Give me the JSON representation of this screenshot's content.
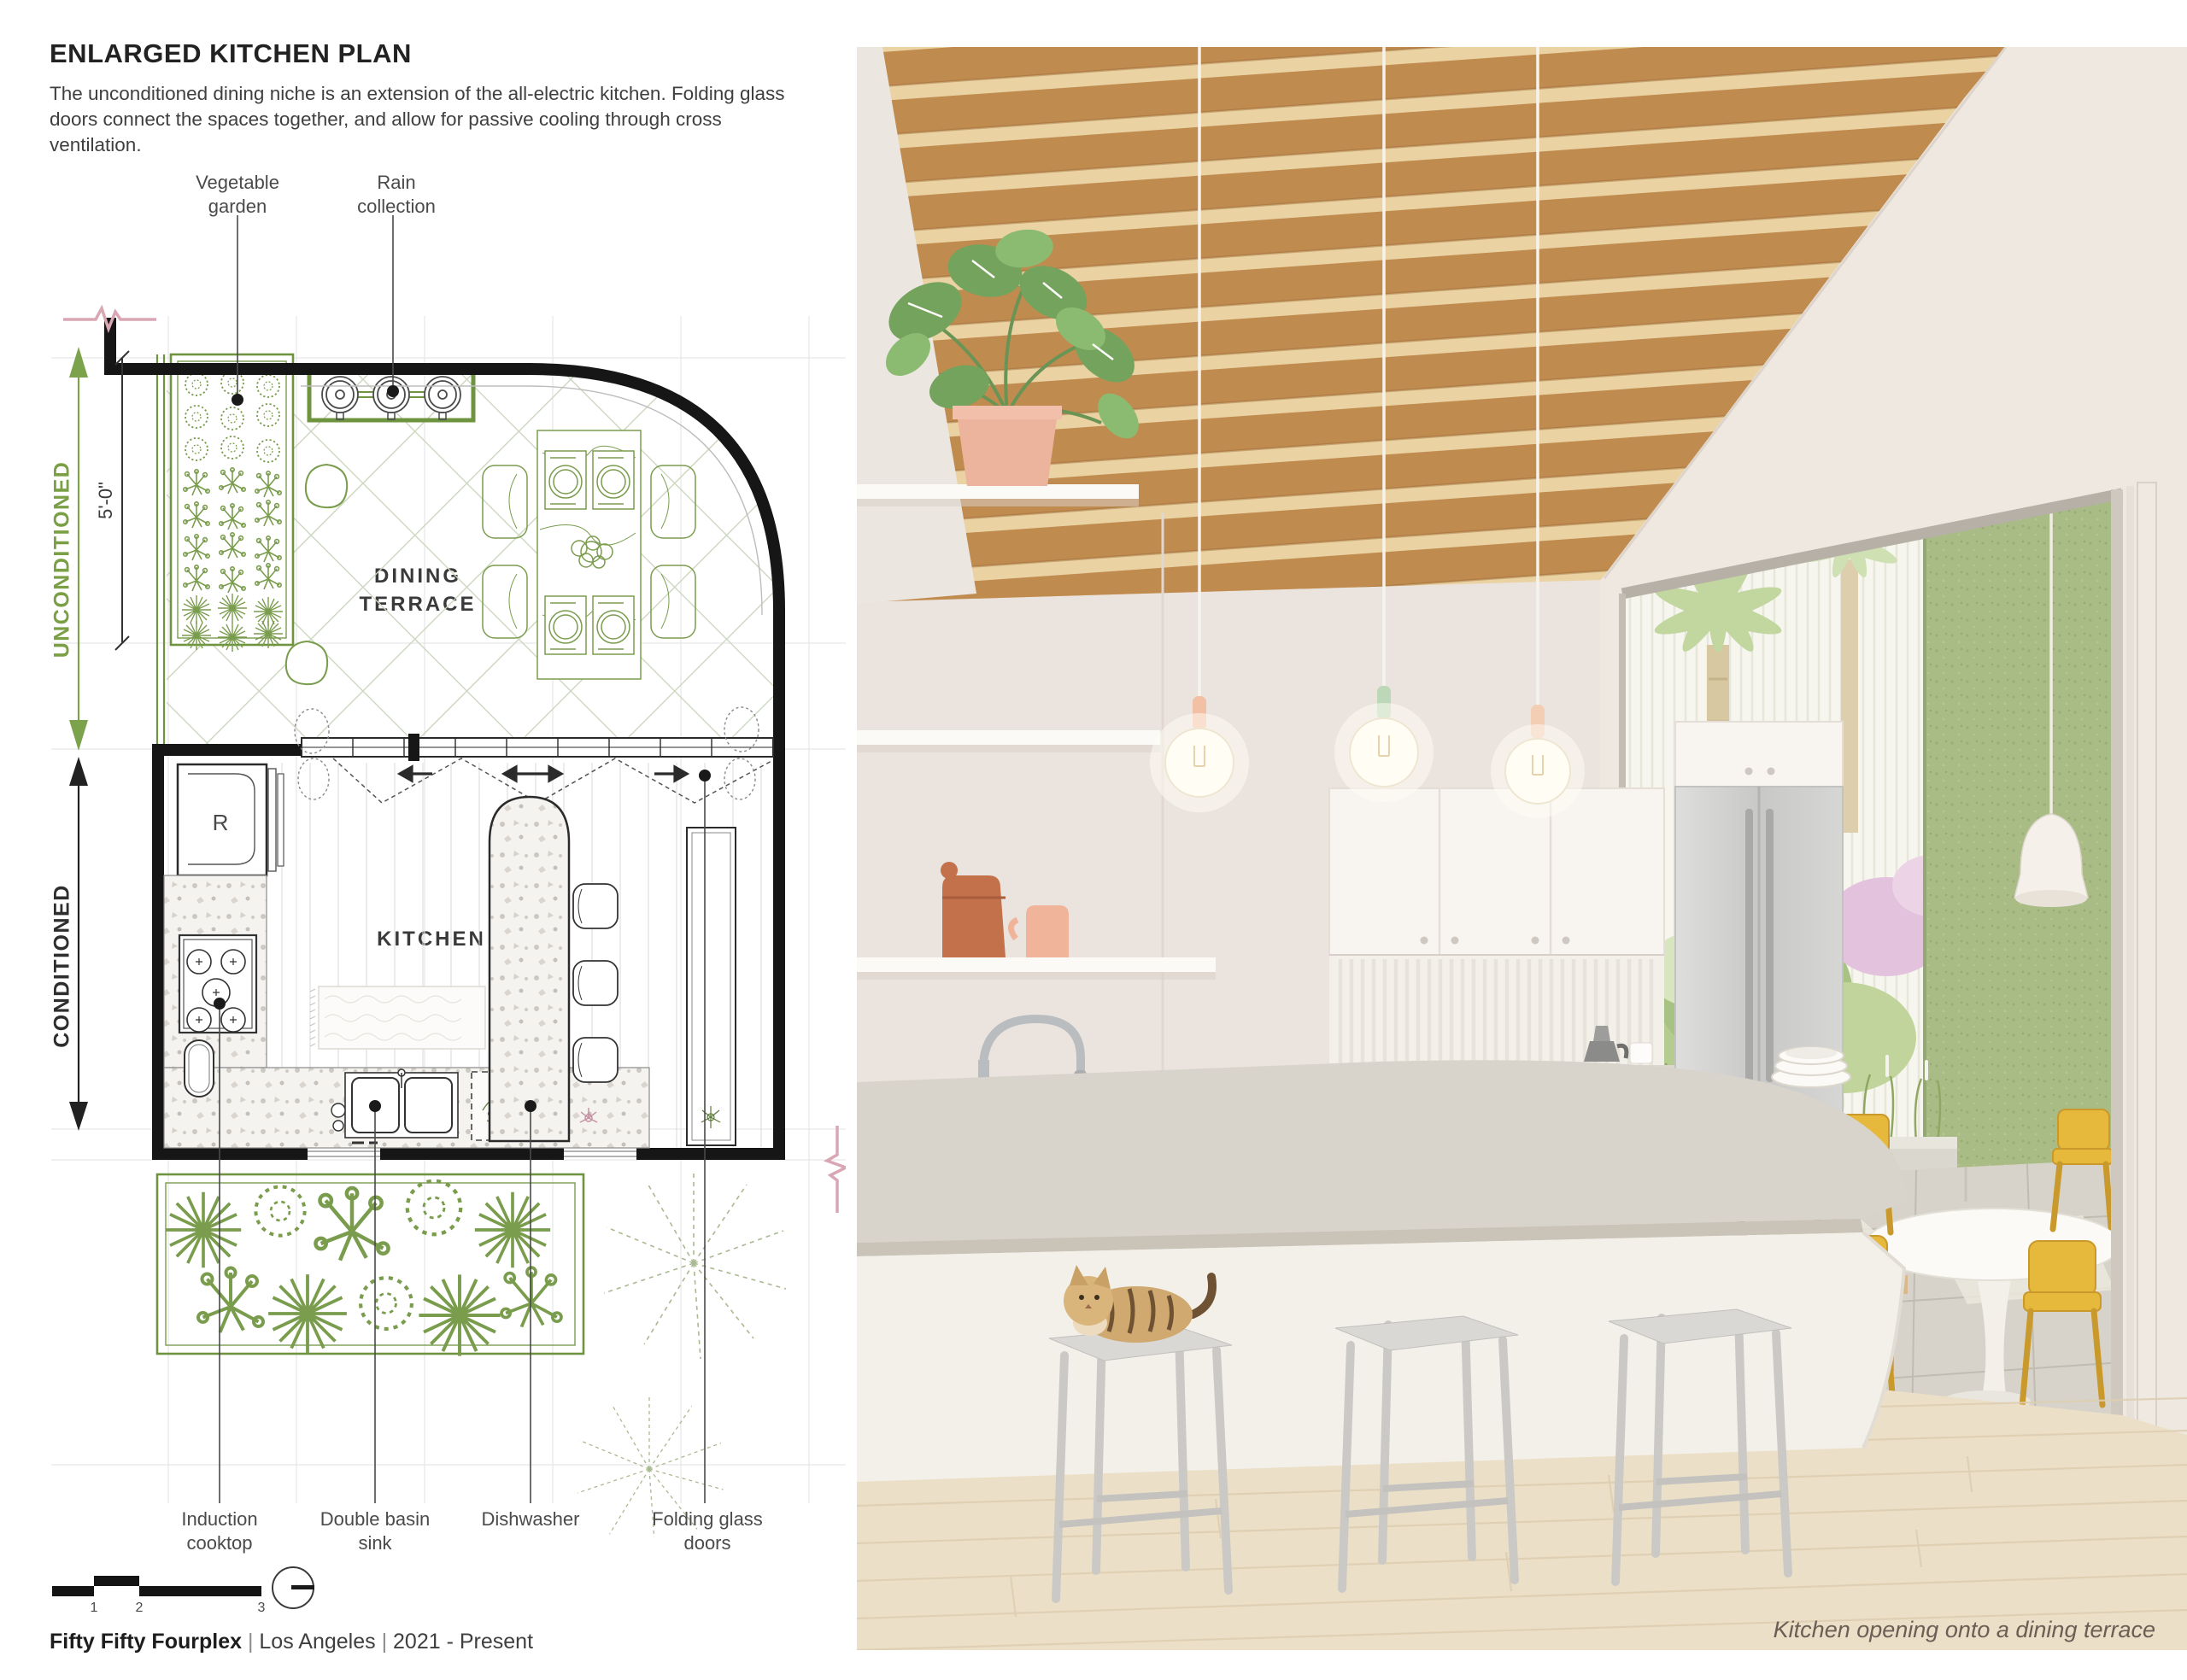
{
  "header": {
    "title": "ENLARGED KITCHEN PLAN",
    "description": "The unconditioned dining niche is an extension of the all-electric kitchen. Folding glass doors connect the spaces together, and allow for passive cooling through cross ventilation."
  },
  "plan": {
    "zone_labels": {
      "unconditioned": "UNCONDITIONED",
      "conditioned": "CONDITIONED"
    },
    "dimension": "5'-0\"",
    "room_labels": {
      "dining_terrace": "DINING TERRACE",
      "kitchen": "KITCHEN",
      "refrigerator": "R"
    },
    "callouts_top": [
      {
        "label": "Vegetable garden"
      },
      {
        "label": "Rain collection"
      }
    ],
    "callouts_bottom": [
      {
        "label": "Induction cooktop"
      },
      {
        "label": "Double basin sink"
      },
      {
        "label": "Dishwasher"
      },
      {
        "label": "Folding glass doors"
      }
    ],
    "colors": {
      "plan_green": "#6f9440",
      "zone_green": "#7a9f45",
      "section_cut_pink": "#d9a6b4",
      "wall_black": "#161616"
    }
  },
  "scale_bar": {
    "ticks": [
      "1",
      "2",
      "3"
    ],
    "icon": "north-indicator"
  },
  "footer": {
    "project": "Fifty Fifty Fourplex",
    "separator": "|",
    "location": "Los Angeles",
    "dates": "2021 - Present"
  },
  "render": {
    "caption": "Kitchen opening onto a dining terrace",
    "colors": {
      "wood_beam": "#c08b4f",
      "chair_yellow": "#e6b83c",
      "stucco_green": "#a9bc85",
      "pendant_socket_peach": "#f2c0a4",
      "pendant_socket_mint": "#bdd8b8",
      "terracotta": "#c3714b"
    }
  }
}
